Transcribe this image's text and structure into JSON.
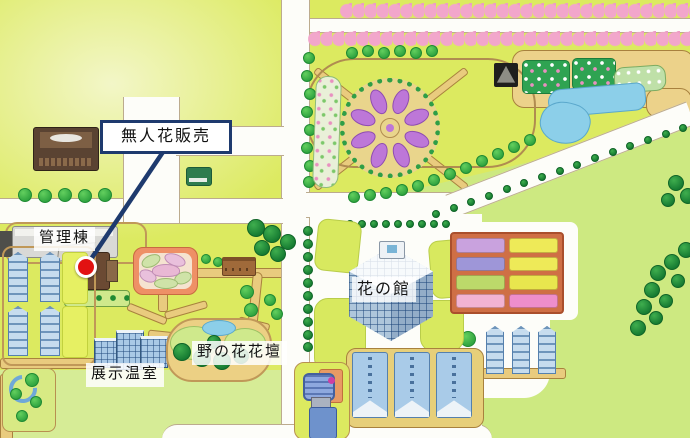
{
  "map": {
    "type": "illustrated flower-park guide map",
    "callout": {
      "label": "無人花販売"
    },
    "labels": {
      "management_building": "管理棟",
      "exhibition_greenhouse": "展示温室",
      "wildflower_bed": "野の花花壇",
      "flower_hall": "花の館"
    },
    "marker": {
      "shape": "red-dot",
      "color": "#e21212"
    },
    "colors": {
      "callout_border": "#1e3a6e",
      "leader_line": "#1e3a6e",
      "grass": "#dcea60",
      "lawn": "#cde981",
      "road": "#fdfdf9",
      "path_tan": "#e9cb7e",
      "blossom_pink": "#f2a6cb",
      "flower_purple": "#bd77d8",
      "pond_blue": "#8ccfe9",
      "greenhouse_blue": "#a9c9e6",
      "flower_grid_frame": "#cf6f45"
    }
  }
}
